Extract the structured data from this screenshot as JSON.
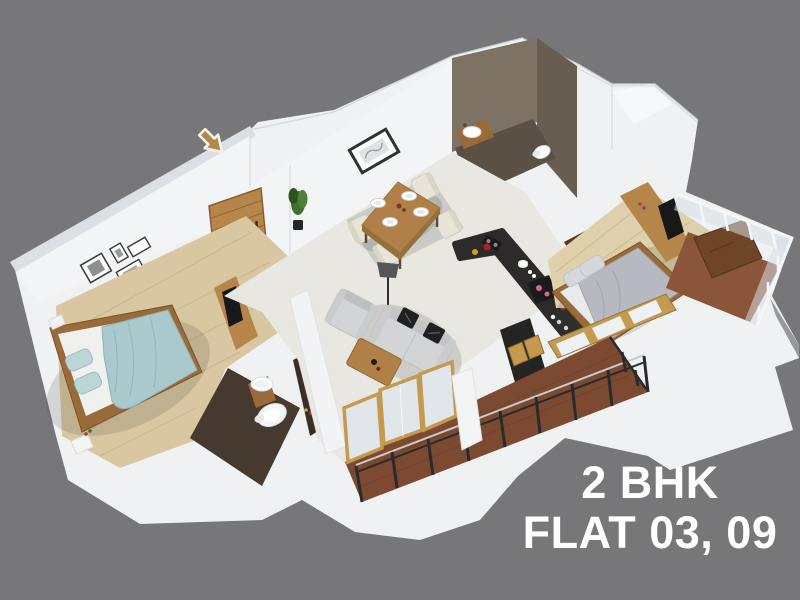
{
  "caption": {
    "line1": "2 BHK",
    "line2": "FLAT 03, 09"
  },
  "entrance": {
    "arrow_icon": "down-right-arrow"
  },
  "colors": {
    "bg": "#77777a",
    "base": "#eff1f3",
    "base-dark": "#97989c",
    "wall": "#f2f4f6",
    "taupe": "#7d7264",
    "taupe-dark": "#675d51",
    "bath-floor": "#5a5045",
    "bath2-floor": "#463930",
    "wood-floor": "#d8c7a0",
    "wood-floor2": "#ddd0ab",
    "plank": "#b9a57e",
    "cream-floor": "#e9e7e1",
    "rug": "#cacac6",
    "wood": "#b5854a",
    "wood-dark": "#9a6b3a",
    "door": "#b5854a",
    "counter": "#2c2b29",
    "island": "#242423",
    "gold": "#c49a50",
    "glass": "#e0e6e9",
    "bed-blue": "#a9c9cd",
    "bed-blue-dark": "#8fb3b8",
    "pillow-blue": "#bcd6d8",
    "mattress": "#f0f1ef",
    "bed-gray": "#b6bac0",
    "pillow-gray": "#d5d8db",
    "sofa": "#d2d4d5",
    "sofa-dark": "#bcbfc1",
    "cushion": "#202022",
    "table-wood": "#b08048",
    "plant": "#44702f",
    "plant-dark": "#2f5220",
    "plant-light": "#4e8136",
    "pot": "#262626",
    "railing": "#2a2a2c",
    "rail-light": "#c9cbcd",
    "white-rail": "#f4f6f8",
    "balcony-floor": "#7c4a31",
    "balcony-floor2": "#8a5538",
    "tv": "#17181a",
    "arrow": "#b08948",
    "arrow-outline": "#f6f1e7",
    "caption": "#ffffff",
    "frame-dark": "#3a3c3e",
    "shadow": "rgba(60,60,65,0.16)"
  }
}
